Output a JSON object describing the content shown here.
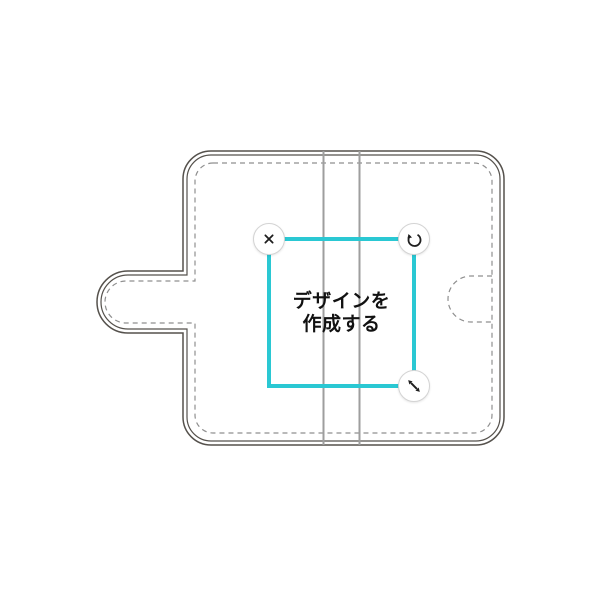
{
  "editor": {
    "placeholder": {
      "line1": "デザインを",
      "line2": "作成する"
    }
  },
  "controls": {
    "icons": {
      "delete": "x-close",
      "rotate": "rotate-ccw",
      "resize": "resize-diagonal"
    }
  },
  "template": {
    "kind": "flip-phone-case-outline",
    "parts": [
      "front-cover",
      "spine",
      "back-cover",
      "clasp-tab",
      "clasp-landing-mark",
      "stitch-seam"
    ]
  },
  "colors": {
    "accent": "#2AC8D3",
    "outline": "#55514C",
    "stitch": "#8F8F8F",
    "fold": "#9E9E9E",
    "icon": "#1F1F1F",
    "handle_border": "#D4D4D4",
    "background": "#FFFFFF",
    "text": "#111111"
  }
}
